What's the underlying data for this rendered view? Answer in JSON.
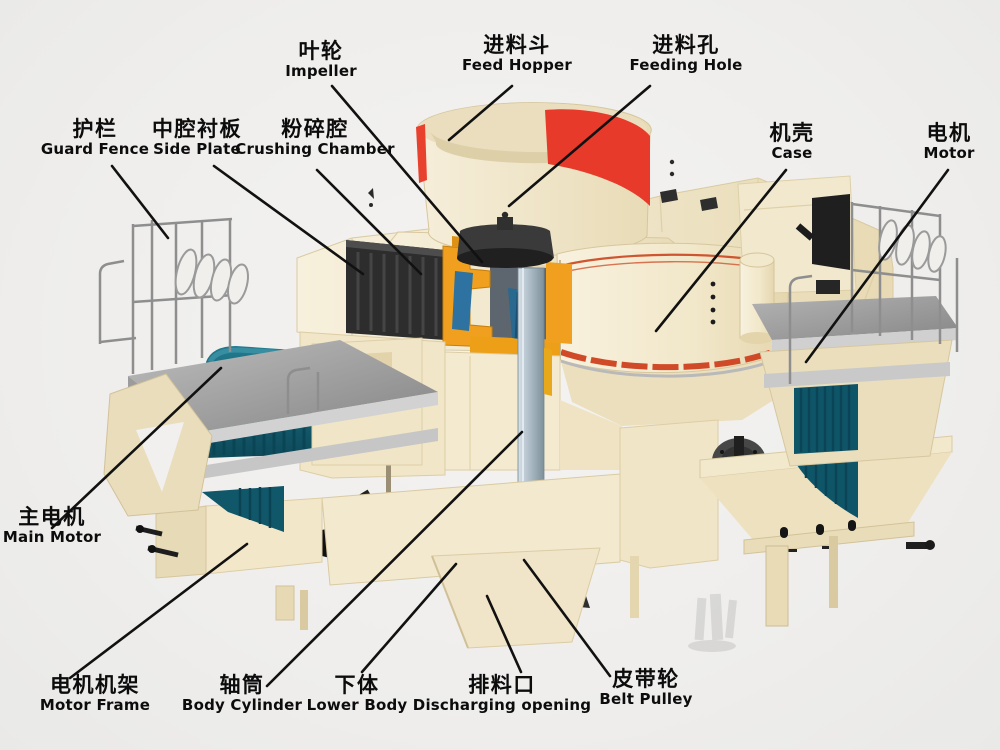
{
  "figure": {
    "type": "labeled-cutaway-diagram",
    "subject": "VSI sand making machine (vertical shaft impact crusher) structure diagram"
  },
  "labels": [
    {
      "id": "impeller",
      "zh": "叶轮",
      "en": "Impeller"
    },
    {
      "id": "feed_hopper",
      "zh": "进料斗",
      "en": "Feed Hopper"
    },
    {
      "id": "feeding_hole",
      "zh": "进料孔",
      "en": "Feeding Hole"
    },
    {
      "id": "guard_fence",
      "zh": "护栏",
      "en": "Guard Fence"
    },
    {
      "id": "side_plate",
      "zh": "中腔衬板",
      "en": "Side Plate"
    },
    {
      "id": "crushing_chamber",
      "zh": "粉碎腔",
      "en": "Crushing Chamber"
    },
    {
      "id": "case",
      "zh": "机壳",
      "en": "Case"
    },
    {
      "id": "motor",
      "zh": "电机",
      "en": "Motor"
    },
    {
      "id": "main_motor",
      "zh": "主电机",
      "en": "Main Motor"
    },
    {
      "id": "motor_frame",
      "zh": "电机机架",
      "en": "Motor Frame"
    },
    {
      "id": "body_cylinder",
      "zh": "轴筒",
      "en": "Body Cylinder"
    },
    {
      "id": "lower_body",
      "zh": "下体",
      "en": "Lower Body"
    },
    {
      "id": "discharging_opening",
      "zh": "排料口",
      "en": "Discharging opening"
    },
    {
      "id": "belt_pulley",
      "zh": "皮带轮",
      "en": "Belt Pulley"
    }
  ],
  "colors": {
    "background": "#f1f0ee",
    "body_cream": "#f2e8cd",
    "body_cream_shadow": "#e6d8b2",
    "hopper_red": "#e8402e",
    "case_stripe_red": "#d04a28",
    "chamber_orange": "#f0a01e",
    "impeller_dark": "#383838",
    "side_plate_dark": "#2d2d2d",
    "inner_blue": "#2d72a0",
    "motor_teal": "#156070",
    "platform_gray": "#a2a2a2",
    "shaft_gray": "#b9c6d2",
    "rail_gray": "#8e8e8e",
    "label_text": "#0c0c0c",
    "leader_line": "#111111"
  }
}
